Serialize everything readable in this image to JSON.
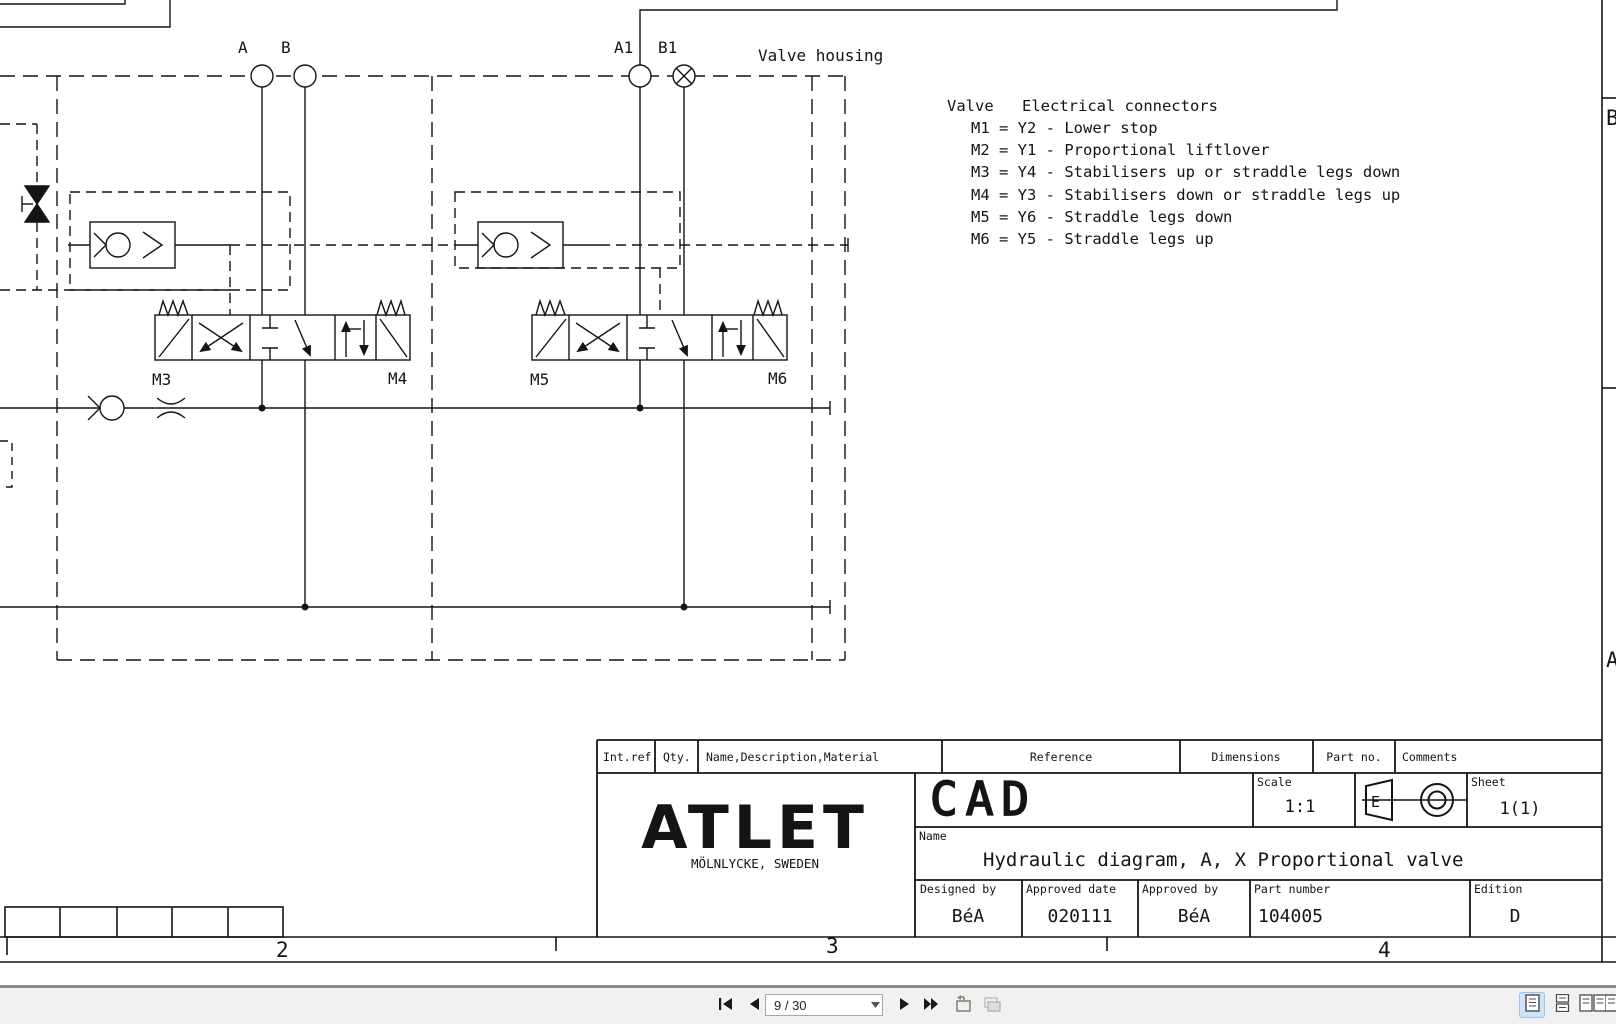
{
  "drawing": {
    "housing_label": "Valve housing",
    "ports": {
      "a": "A",
      "b": "B",
      "a1": "A1",
      "b1": "B1"
    },
    "valves": {
      "m3": "M3",
      "m4": "M4",
      "m5": "M5",
      "m6": "M6"
    },
    "legend": {
      "col1_title": "Valve",
      "col2_title": "Electrical connectors",
      "rows": [
        "M1 = Y2 - Lower stop",
        "M2 = Y1 - Proportional liftlover",
        "M3 = Y4 - Stabilisers up or straddle legs down",
        "M4 = Y3 - Stabilisers down or straddle legs up",
        "M5 = Y6 - Straddle legs down",
        "M6 = Y5 - Straddle legs up"
      ]
    },
    "zones": {
      "right_top": "B",
      "right_bottom": "A",
      "bottom_2": "2",
      "bottom_3": "3",
      "bottom_4": "4"
    },
    "title_block": {
      "headers": [
        "Int.ref",
        "Qty.",
        "Name,Description,Material",
        "Reference",
        "Dimensions",
        "Part no.",
        "Comments"
      ],
      "cad_label": "CAD",
      "scale_label": "Scale",
      "scale_value": "1:1",
      "sheet_label": "Sheet",
      "sheet_value": "1(1)",
      "name_label": "Name",
      "name_value": "Hydraulic diagram, A, X Proportional valve",
      "designed_by_label": "Designed by",
      "designed_by_value": "BéA",
      "approved_date_label": "Approved date",
      "approved_date_value": "020111",
      "approved_by_label": "Approved by",
      "approved_by_value": "BéA",
      "part_number_label": "Part number",
      "part_number_value": "104005",
      "edition_label": "Edition",
      "edition_value": "D",
      "company": "ATLET",
      "company_location": "MÖLNLYCKE, SWEDEN",
      "projection_letter": "E"
    }
  },
  "toolbar": {
    "page_indicator": "9 / 30"
  }
}
